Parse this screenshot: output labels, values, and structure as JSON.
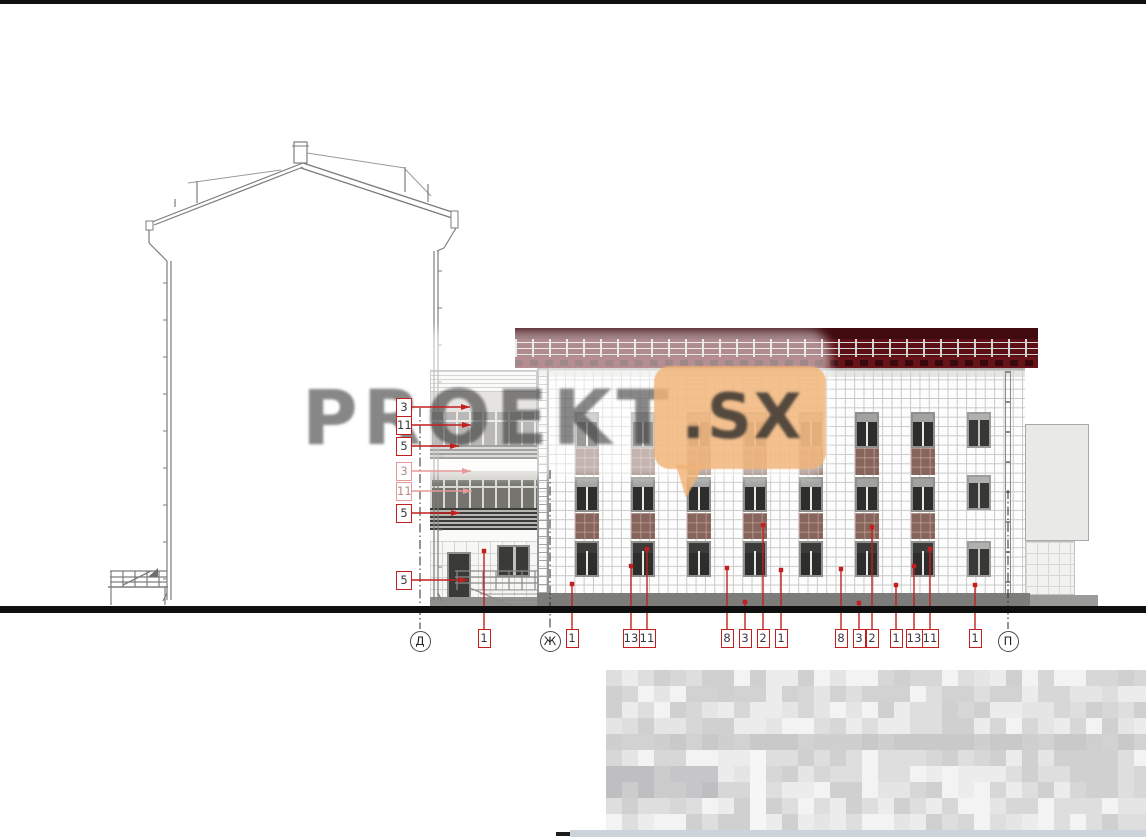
{
  "document": {
    "type": "architectural elevation drawing",
    "description": "Street facade elevation of a 3-4 storey tiled building with section through adjacent gable-roof house, entrance link block, axis markers and material callouts"
  },
  "watermark": {
    "text": "PROEKT",
    "bubble_text": ".SX"
  },
  "axis_markers": [
    {
      "label": "Д",
      "x": 420,
      "line_top": 408
    },
    {
      "label": "Ж",
      "x": 550,
      "line_top": 470
    },
    {
      "label": "П",
      "x": 1008,
      "line_top": 490
    }
  ],
  "bottom_callouts": [
    {
      "label": "1",
      "x": 484,
      "tip_y": 551
    },
    {
      "label": "1",
      "x": 572,
      "tip_y": 584
    },
    {
      "label": "13",
      "x": 631,
      "tip_y": 566
    },
    {
      "label": "11",
      "x": 647,
      "tip_y": 549
    },
    {
      "label": "8",
      "x": 727,
      "tip_y": 568
    },
    {
      "label": "3",
      "x": 745,
      "tip_y": 602
    },
    {
      "label": "2",
      "x": 763,
      "tip_y": 525
    },
    {
      "label": "1",
      "x": 781,
      "tip_y": 570
    },
    {
      "label": "8",
      "x": 841,
      "tip_y": 569
    },
    {
      "label": "3",
      "x": 859,
      "tip_y": 603
    },
    {
      "label": "2",
      "x": 872,
      "tip_y": 527
    },
    {
      "label": "1",
      "x": 896,
      "tip_y": 585
    },
    {
      "label": "13",
      "x": 914,
      "tip_y": 566
    },
    {
      "label": "11",
      "x": 930,
      "tip_y": 549
    },
    {
      "label": "1",
      "x": 975,
      "tip_y": 585
    }
  ],
  "left_callouts": [
    {
      "label": "3",
      "y": 407,
      "tip_x": 470,
      "faded": false
    },
    {
      "label": "11",
      "y": 425,
      "tip_x": 471,
      "faded": false
    },
    {
      "label": "5",
      "y": 446,
      "tip_x": 459,
      "faded": false
    },
    {
      "label": "3",
      "y": 471,
      "tip_x": 471,
      "faded": true
    },
    {
      "label": "11",
      "y": 491,
      "tip_x": 472,
      "faded": true
    },
    {
      "label": "5",
      "y": 513,
      "tip_x": 460,
      "faded": false
    },
    {
      "label": "5",
      "y": 580,
      "tip_x": 468,
      "faded": false
    }
  ],
  "facade": {
    "window_columns": [
      {
        "x": 575,
        "spandrels": true
      },
      {
        "x": 631,
        "spandrels": true
      },
      {
        "x": 687,
        "spandrels": true
      },
      {
        "x": 743,
        "spandrels": true
      },
      {
        "x": 799,
        "spandrels": true
      },
      {
        "x": 855,
        "spandrels": true
      },
      {
        "x": 911,
        "spandrels": true
      },
      {
        "x": 967,
        "spandrels": false
      }
    ]
  },
  "colors": {
    "roof_dark": "#400a0f",
    "roof_mid": "#5c1016",
    "roof_low": "#66141a",
    "spandrel_panel": "#86655c",
    "window_glass": "#2d2d2b",
    "window_frame": "#8f8f8d",
    "plinth": "#7c7c7a",
    "ground_line": "#0f0f0f",
    "callout_red": "#c41f1f",
    "callout_red_faded": "#e59a9a",
    "watermark_bubble": "#f0b275",
    "watermark_gray": "#3c3c3c",
    "bottom_strip": "#cdd3da"
  },
  "censored_title_block": {
    "seed": 7,
    "rows": 10,
    "cols": 34,
    "cell": 16,
    "palette": [
      "#f3f3f3",
      "#ececec",
      "#e5e5e5",
      "#dedede",
      "#d7d7d7",
      "#d0d0d0"
    ]
  }
}
